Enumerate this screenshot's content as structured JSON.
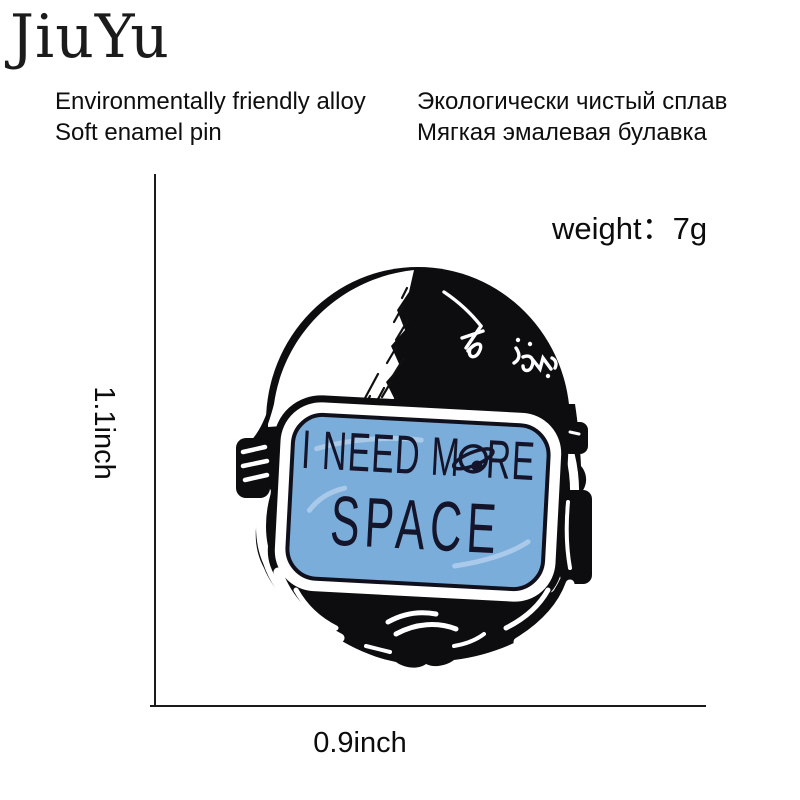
{
  "brand": {
    "logo_text": "JiuYu"
  },
  "description": {
    "en_line1": "Environmentally friendly alloy",
    "en_line2": "Soft enamel pin",
    "ru_line1": "Экологически чистый сплав",
    "ru_line2": "Мягкая эмалевая булавка"
  },
  "spec": {
    "weight_text": "weight：7g"
  },
  "dimensions": {
    "height": "1.1inch",
    "width": "0.9inch"
  },
  "product": {
    "name": "astronaut helmet soft enamel pin",
    "visor": {
      "full_text": "I NEED MORE SPACE",
      "line1_prefix": "I NEED M",
      "line1_suffix": "RE",
      "line2": "SPACE"
    }
  },
  "colors": {
    "visor_blue": "#7badda",
    "outline_black": "#0d0d0f",
    "text_navy": "#14142a"
  }
}
